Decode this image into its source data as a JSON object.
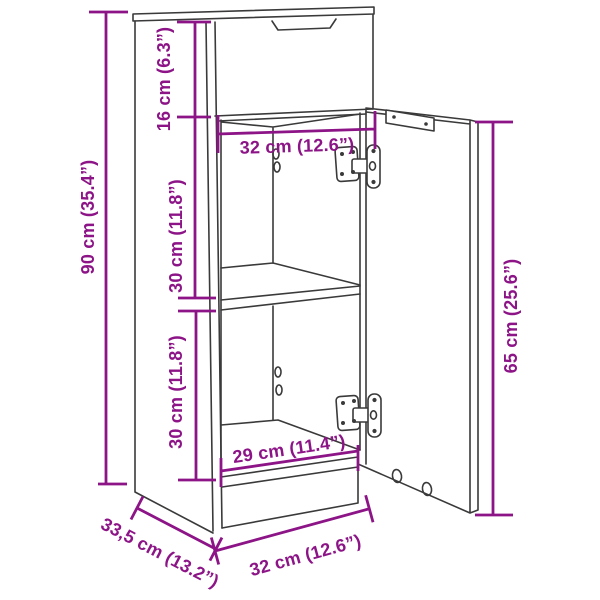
{
  "page": {
    "background": "#ffffff"
  },
  "diagram": {
    "kind": "furniture-dimension-line-drawing",
    "subject": "narrow cabinet with top drawer, middle shelf and open right-hinged door",
    "line_color": "#3a3a3a",
    "dimension_color": "#8c1487",
    "dimensions": [
      {
        "id": "overall-height",
        "label": "90 cm (35.4”)",
        "cm": 90,
        "inch": 35.4
      },
      {
        "id": "drawer-section-height",
        "label": "16 cm (6.3”)",
        "cm": 16,
        "inch": 6.3
      },
      {
        "id": "upper-compartment-height",
        "label": "30 cm (11.8”)",
        "cm": 30,
        "inch": 11.8
      },
      {
        "id": "lower-compartment-height",
        "label": "30 cm (11.8”)",
        "cm": 30,
        "inch": 11.8
      },
      {
        "id": "inner-width-top",
        "label": "32 cm (12.6”)",
        "cm": 32,
        "inch": 12.6
      },
      {
        "id": "door-height",
        "label": "65 cm (25.6”)",
        "cm": 65,
        "inch": 25.6
      },
      {
        "id": "inner-width-bottom",
        "label": "29 cm (11.4”)",
        "cm": 29,
        "inch": 11.4
      },
      {
        "id": "depth",
        "label": "33,5 cm (13.2”)",
        "cm": 33.5,
        "inch": 13.2
      },
      {
        "id": "overall-width",
        "label": "32 cm (12.6”)",
        "cm": 32,
        "inch": 12.6
      }
    ]
  }
}
